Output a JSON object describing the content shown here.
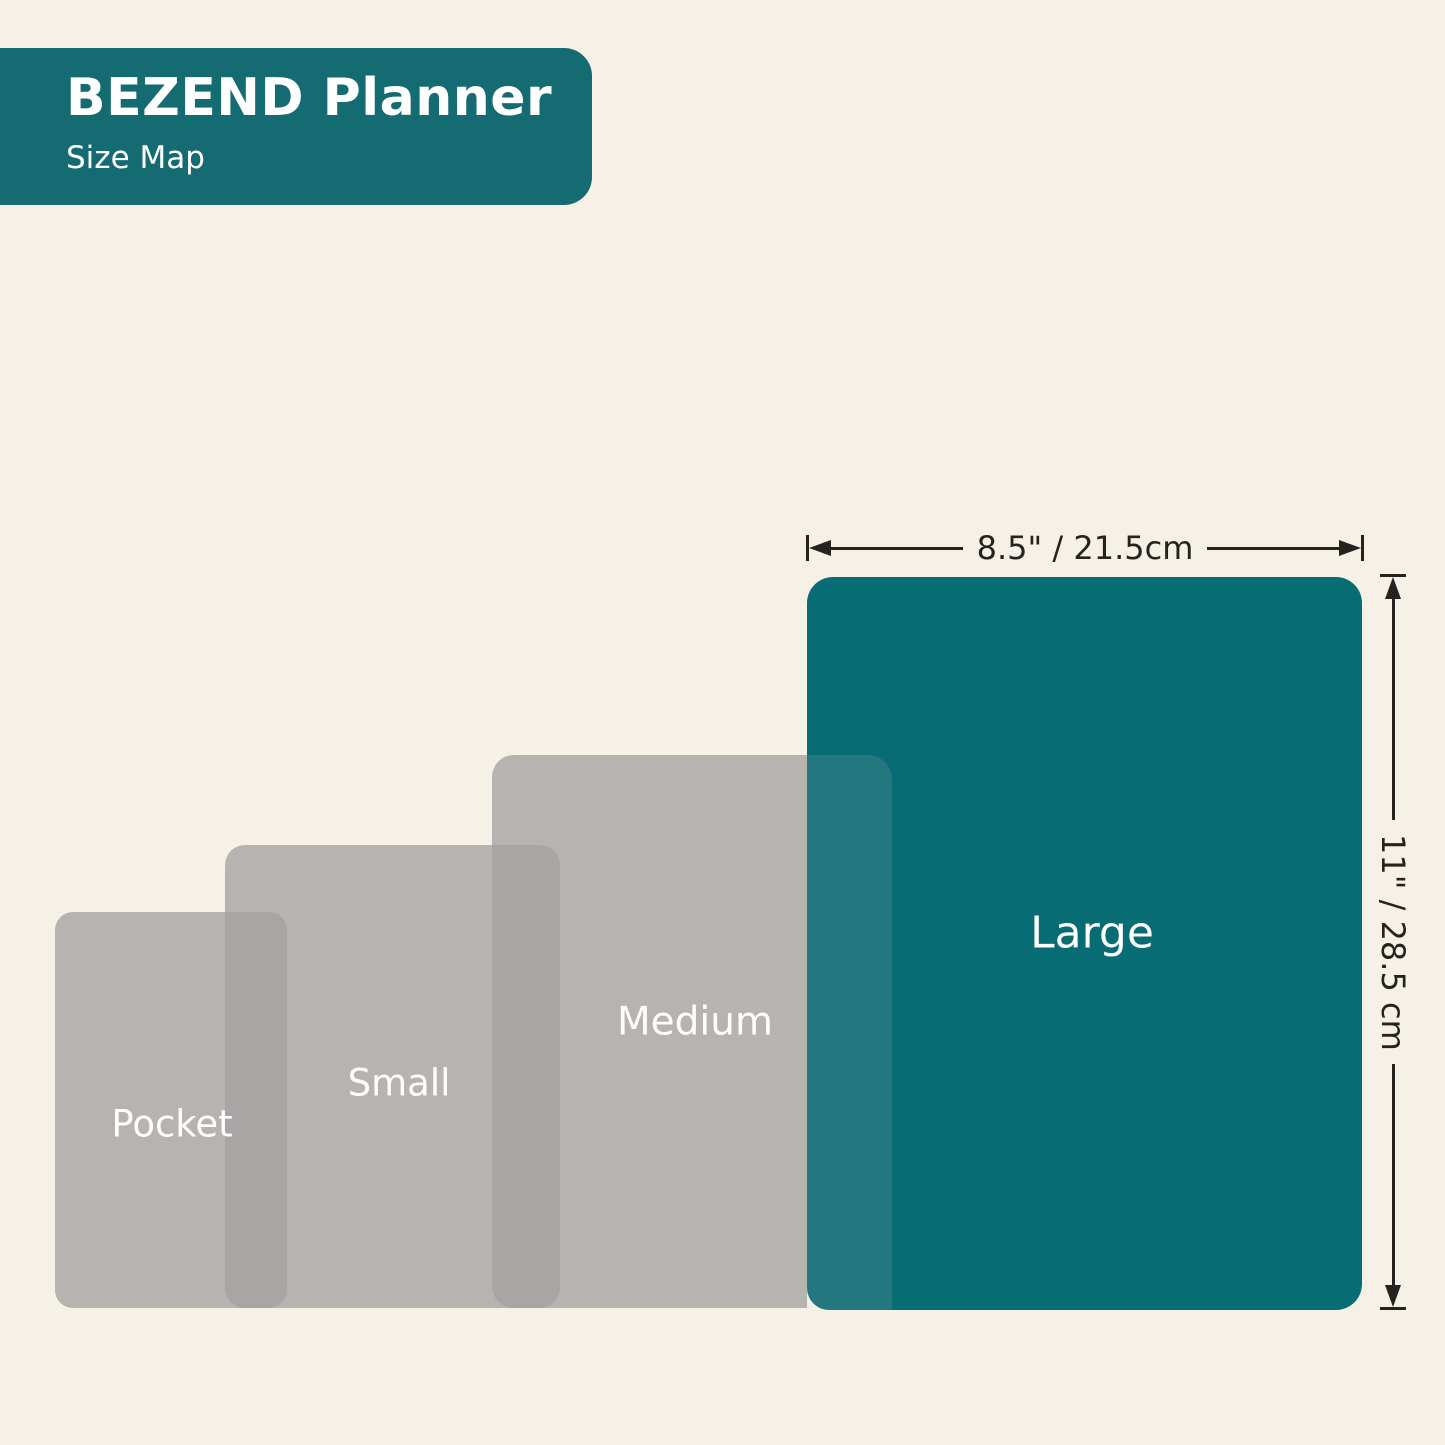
{
  "header": {
    "title": "BEZEND Planner",
    "subtitle": "Size Map"
  },
  "sizes": [
    {
      "id": "pocket",
      "label": "Pocket"
    },
    {
      "id": "small",
      "label": "Small"
    },
    {
      "id": "medium",
      "label": "Medium"
    },
    {
      "id": "large",
      "label": "Large"
    }
  ],
  "dimensions": {
    "width_label": "8.5\" / 21.5cm",
    "height_label": "11\" / 28.5 cm"
  },
  "colors": {
    "background": "#F6F1E7",
    "teal": "#076C74",
    "teal_header": "#146B72",
    "overlap_teal": "#23787F",
    "gray": "rgba(164,162,160,0.78)",
    "line": "#262220",
    "label_text": "#FFFFFF"
  }
}
